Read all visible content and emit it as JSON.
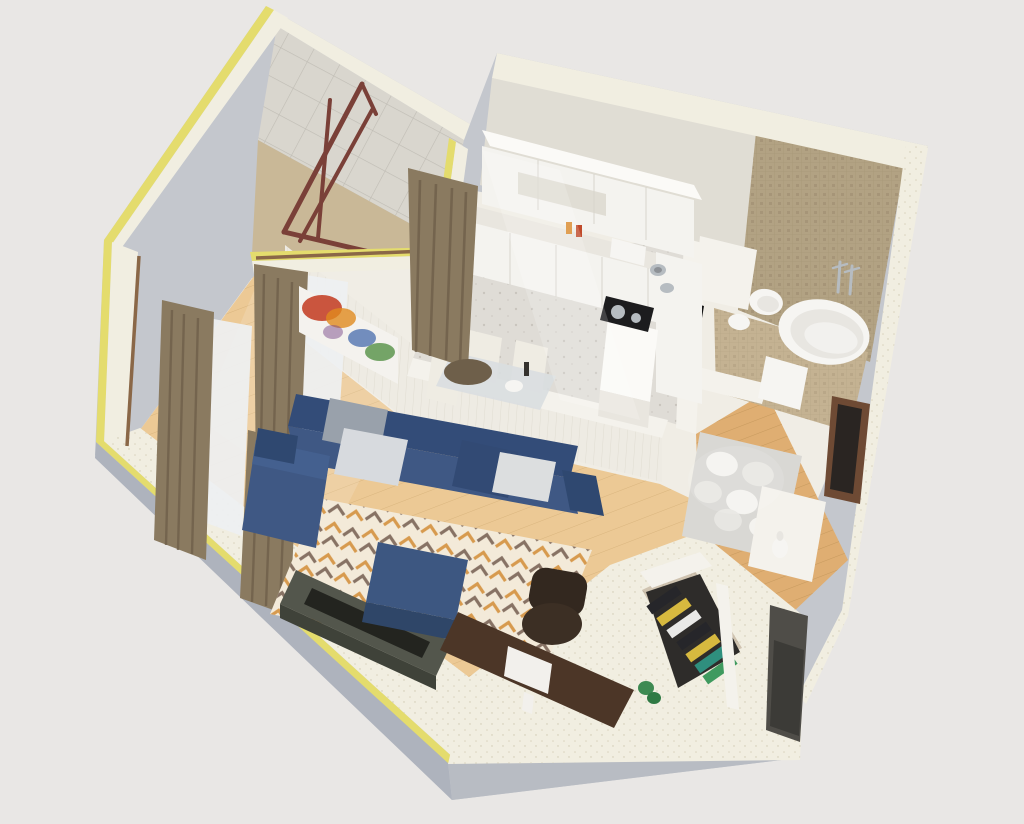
{
  "scene": {
    "type": "3d-floorplan-cutaway-render",
    "rooms": [
      "balcony",
      "living-room",
      "kitchen-dining",
      "bathroom",
      "hallway",
      "wardrobe-closet"
    ],
    "objects": [
      "blue-sectional-sofa",
      "ottoman",
      "geometric-rug",
      "tv-console",
      "desk",
      "monitor",
      "office-chair",
      "curtains",
      "abstract-painting",
      "kitchen-cabinets",
      "cooktop",
      "sink",
      "dining-table",
      "dining-chairs",
      "toilet",
      "bidet",
      "bathtub",
      "faucet",
      "hall-rug",
      "console-table",
      "vase",
      "entrance-door",
      "hanging-clothes",
      "plant",
      "balcony-railing",
      "tiled-wall"
    ]
  },
  "colors": {
    "background": "#e9e7e5",
    "outer_wall": "#c4c7cd",
    "outer_wall_dark": "#aeb3bd",
    "plinth": "#b8bcc3",
    "cream": "#f1eee1",
    "cream_shadow": "#e4e0d1",
    "yellow_strip": "#e4dc6d",
    "interior_white": "#f0ede5",
    "wall_white": "#f4f2ec",
    "wall_face": "#eeebe3",
    "wall_shadow": "#e0ddd4",
    "tile_wall": "#d9d6ce",
    "railing": "#7a4038",
    "balcony_floor": "#c9b897",
    "wood": "#ecc995",
    "wood_light": "#f5dcab",
    "hall_wood": "#dfae72",
    "concrete": "#dfdcd6",
    "stone": "#cfc3b0",
    "mosaic_wall": "#b2a283",
    "mosaic_floor": "#c4b292",
    "white_fixture": "#f6f5f2",
    "fixture_inner": "#e8e6e1",
    "chrome": "#b6bcc1",
    "sofa": "#3f5884",
    "sofa_dark": "#334c78",
    "sofa_darker": "#2f4870",
    "sofa_light": "#44608f",
    "pillow_gray": "#99a1ab",
    "pillow_light": "#d7dade",
    "pillow_white": "#dcdedf",
    "pillow_navy": "#324a74",
    "ottoman_top": "#3d5781",
    "ottoman_front": "#2f4668",
    "rug_base": "#f3ead9",
    "rug_orange": "#d79a4e",
    "rug_taupe": "#877264",
    "curtain": "#8a7a60",
    "curtain_dark": "#6e5f4a",
    "sheer": "#eef0f2",
    "rod_wood": "#8a6747",
    "cabinet": "#f4f3ef",
    "cabinet_top": "#fbfaf7",
    "counter": "#e9e6df",
    "cooktop": "#1c1c1e",
    "niche_dark": "#151515",
    "niche_gray": "#4f4d48",
    "desk": "#4c3627",
    "chair_back": "#33281f",
    "chair_seat": "#3c2f24",
    "console": "#53564c",
    "console_front": "#3f4239",
    "tv": "#23241f",
    "monitor": "#f2f0ec",
    "door_dark": "#2a2522",
    "door_frame": "#6e4a34",
    "hall_rug": "#d9d8d4",
    "hall_rug_oval": "#f4f3ef",
    "hall_rug_oval2": "#e7e6e2",
    "console_white": "#f4f2ec",
    "clothes_yellow": "#d7b93f",
    "clothes_black": "#26262a",
    "clothes_white": "#e9e9e7",
    "clothes_teal": "#2f8f7e",
    "clothes_green": "#3f9a5f",
    "closet_shadow": "#2e2c2a",
    "plant": "#3e8a52",
    "plant_dark": "#2f7a44",
    "paint_red": "#c23a1f",
    "paint_orange": "#e08a1e",
    "paint_blue": "#3a63a8",
    "paint_green": "#4a8a3a",
    "paint_purple": "#7a4a8a",
    "canvas_white": "#f4f2ee",
    "table_glass": "#d9dee0",
    "chair_cream": "#efece3"
  }
}
